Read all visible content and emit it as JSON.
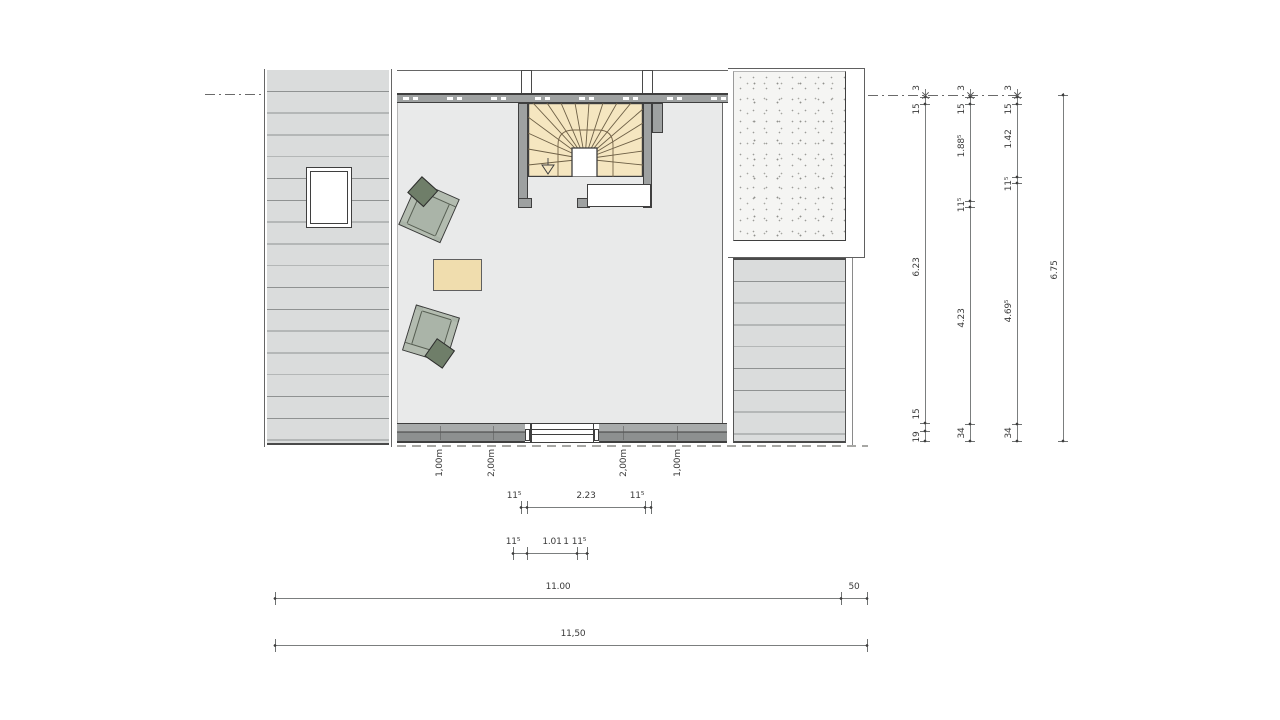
{
  "drawing": {
    "kind": "floor-plan-attic",
    "colors": {
      "floor": "#e9eaea",
      "roof_hatch": "#dadcdc",
      "wall": "#9ea1a1",
      "wall_dark": "#8d9090",
      "stair_tread": "#f5e6c0",
      "table": "#f0ddae",
      "chair": "#aab4a8",
      "chair_cushion": "#6f7e69",
      "terrace": "#f5f5f3",
      "dim_line": "#7b7e7e",
      "dim_text": "#3a3a3a"
    }
  },
  "dims": {
    "right_chains": [
      {
        "values": [
          "3",
          "15",
          "6.23",
          "15",
          "19"
        ]
      },
      {
        "values": [
          "3",
          "15",
          "1.88⁵",
          "11⁵",
          "4.23",
          "34"
        ]
      },
      {
        "values": [
          "3",
          "15",
          "1.42",
          "11⁵",
          "4.69⁵",
          "34"
        ]
      },
      {
        "values": [
          "6.75"
        ]
      }
    ],
    "window_chain": {
      "values": [
        "11⁵",
        "2.23",
        "11⁵"
      ]
    },
    "door_chain": {
      "values": [
        "11⁵",
        "1.01",
        "1",
        "11⁵"
      ]
    },
    "overall_chain": {
      "values": [
        "11.00",
        "50"
      ]
    },
    "total_chain": {
      "values": [
        "11,50"
      ]
    },
    "roof_height_labels": [
      "1,00m",
      "2,00m",
      "2,00m",
      "1,00m"
    ]
  }
}
